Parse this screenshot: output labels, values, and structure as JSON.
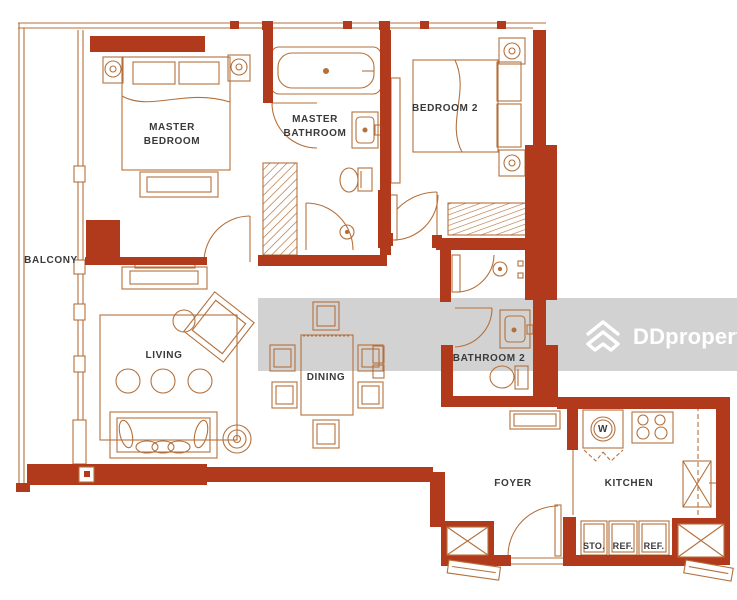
{
  "floor_plan": {
    "rooms": {
      "balcony": {
        "label": "BALCONY"
      },
      "master_bedroom": {
        "line1": "MASTER",
        "line2": "BEDROOM"
      },
      "master_bathroom": {
        "line1": "MASTER",
        "line2": "BATHROOM"
      },
      "bedroom2": {
        "label": "BEDROOM 2"
      },
      "living": {
        "label": "LIVING"
      },
      "dining": {
        "label": "DINING"
      },
      "bathroom2": {
        "label": "BATHROOM 2"
      },
      "foyer": {
        "label": "FOYER"
      },
      "kitchen": {
        "label": "KITCHEN"
      }
    },
    "appliances": {
      "washer": {
        "label": "W"
      },
      "storage": {
        "label": "STO."
      },
      "refrigerator1": {
        "label": "REF."
      },
      "refrigerator2": {
        "label": "REF."
      }
    }
  },
  "watermark": {
    "brand": "DDproperty"
  },
  "colors": {
    "wall_red": "#b23a1c",
    "outline_brown": "#b4713c",
    "label_text": "#3a3a3a",
    "watermark_band": "#d2d2d2",
    "watermark_text": "#ffffff",
    "background": "#ffffff"
  }
}
